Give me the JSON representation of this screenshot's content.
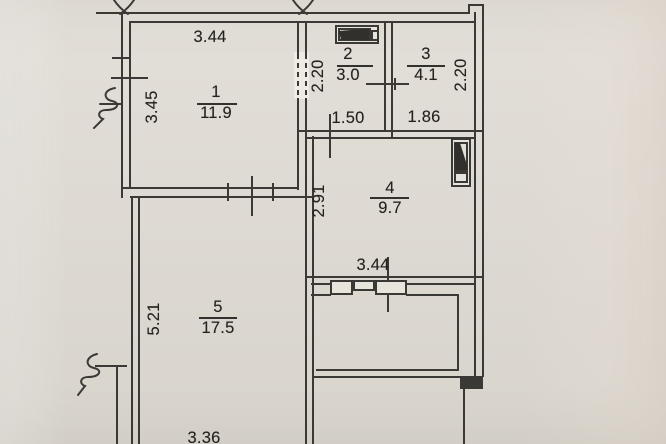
{
  "colors": {
    "paper": "#dfdbd3",
    "ink": "#3a3936"
  },
  "icons": {
    "room2_fixture": "sink-fixture-icon",
    "room4_fixture": "boiler-fixture-icon",
    "top_left_break": "wall-break-icon",
    "top_right_break": "wall-break-icon",
    "left_wall_break_upper": "squiggle-break-icon",
    "left_wall_break_lower": "squiggle-break-icon",
    "balcony_opening": "window-band-icon"
  },
  "rooms": {
    "r1": {
      "number": "1",
      "area": "11.9",
      "dim_top": "3.44",
      "dim_left": "3.45"
    },
    "r2": {
      "number": "2",
      "area": "3.0",
      "dim_left": "2.20",
      "dim_bottom": "1.50"
    },
    "r3": {
      "number": "3",
      "area": "4.1",
      "dim_right": "2.20",
      "dim_bottom": "1.86"
    },
    "r4": {
      "number": "4",
      "area": "9.7",
      "dim_left": "2.91",
      "dim_bottom": "3.44"
    },
    "r5": {
      "number": "5",
      "area": "17.5",
      "dim_left": "5.21",
      "dim_bottom": "3.36"
    }
  }
}
